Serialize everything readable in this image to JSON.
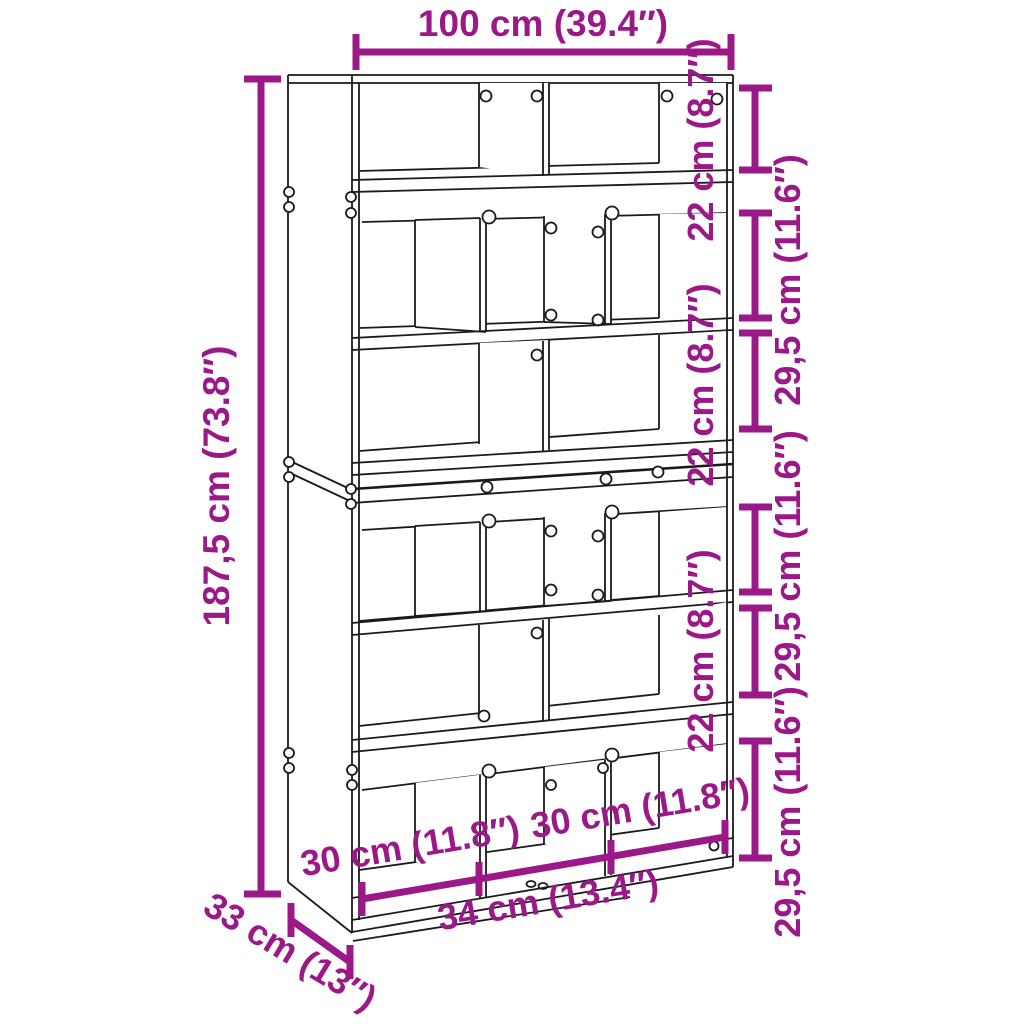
{
  "product": {
    "type_hint": "bookcase-room-divider-dimension-diagram"
  },
  "colors": {
    "dimension_accent": "#9B1889",
    "drawing_line": "#1A1A1A",
    "background": "#FFFFFF"
  },
  "dimensions": {
    "top_width": {
      "label": "100 cm (39.4″)"
    },
    "left_height": {
      "label": "187,5 cm (73.8″)"
    },
    "right_rows": [
      {
        "label": "22 cm (8.7″)"
      },
      {
        "label": "29,5 cm (11.6″)"
      },
      {
        "label": "22 cm (8.7″)"
      },
      {
        "label": "29,5 cm (11.6″)"
      },
      {
        "label": "22 cm (8.7″)"
      },
      {
        "label": "29,5 cm (11.6″)"
      }
    ],
    "bottom_compartments": {
      "left": "30 cm (11.8″)",
      "middle": "34 cm (13.4″)",
      "right": "30 cm (11.8″)"
    },
    "depth": {
      "label": "33 cm (13″)"
    }
  }
}
